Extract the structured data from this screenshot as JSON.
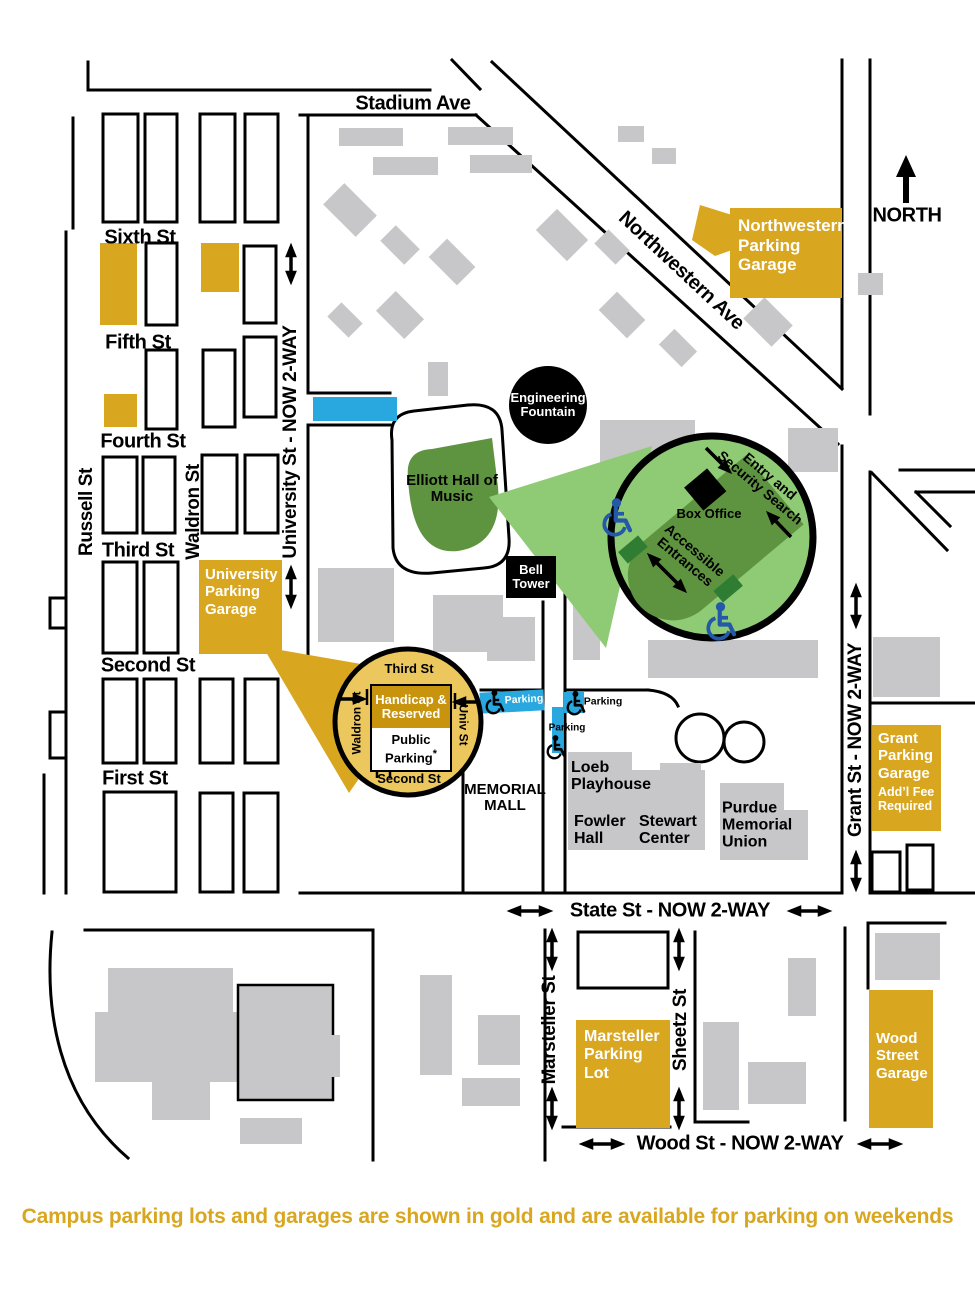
{
  "caption": "Campus parking lots and garages are shown in gold and are available for parking on weekends",
  "north_label": "NORTH",
  "streets": {
    "stadium": "Stadium Ave",
    "northwestern": "Northwestern Ave",
    "sixth": "Sixth St",
    "fifth": "Fifth St",
    "fourth": "Fourth St",
    "third": "Third St",
    "second": "Second St",
    "first": "First St",
    "russell": "Russell St",
    "waldron": "Waldron St",
    "university": "University St - NOW 2-WAY",
    "grant": "Grant St - NOW 2-WAY",
    "state": "State St - NOW 2-WAY",
    "wood": "Wood St - NOW 2-WAY",
    "marsteller": "Marsteller St",
    "sheetz": "Sheetz St"
  },
  "landmarks": {
    "engineering_fountain": "Engineering Fountain",
    "elliott_hall": "Elliott Hall of Music",
    "bell_tower": "Bell Tower",
    "memorial_mall": "MEMORIAL MALL",
    "loeb_playhouse": "Loeb Playhouse",
    "fowler_hall": "Fowler Hall",
    "stewart_center": "Stewart Center",
    "purdue_memorial_union": "Purdue Memorial Union"
  },
  "parking": {
    "northwestern_garage": "Northwestern Parking Garage",
    "university_garage": "University Parking Garage",
    "grant_garage": "Grant Parking Garage",
    "grant_garage_note": "Add’l Fee Required",
    "marsteller_lot": "Marsteller Parking Lot",
    "wood_garage": "Wood Street Garage",
    "parking_label": "Parking"
  },
  "elliott_inset": {
    "entry_line1": "Entry and",
    "entry_line2": "Security Search",
    "box_office": "Box Office",
    "accessible_line1": "Accessible",
    "accessible_line2": "Entrances"
  },
  "garage_inset": {
    "third_st": "Third St",
    "second_st": "Second St",
    "waldron_st": "Waldron St",
    "univ_st": "Univ St",
    "handicap_reserved": "Handicap & Reserved",
    "public_parking": "Public Parking",
    "asterisk": "*"
  },
  "colors": {
    "gold": "#D9A620",
    "gold_light": "#ECC75E",
    "gold_dark": "#C8940E",
    "green_light": "#8FCB75",
    "green_dark": "#5E9340",
    "green_entrance": "#2F7D33",
    "blue": "#29A8E0",
    "handicap_blue": "#2458A8",
    "building_gray": "#C7C7C9"
  }
}
